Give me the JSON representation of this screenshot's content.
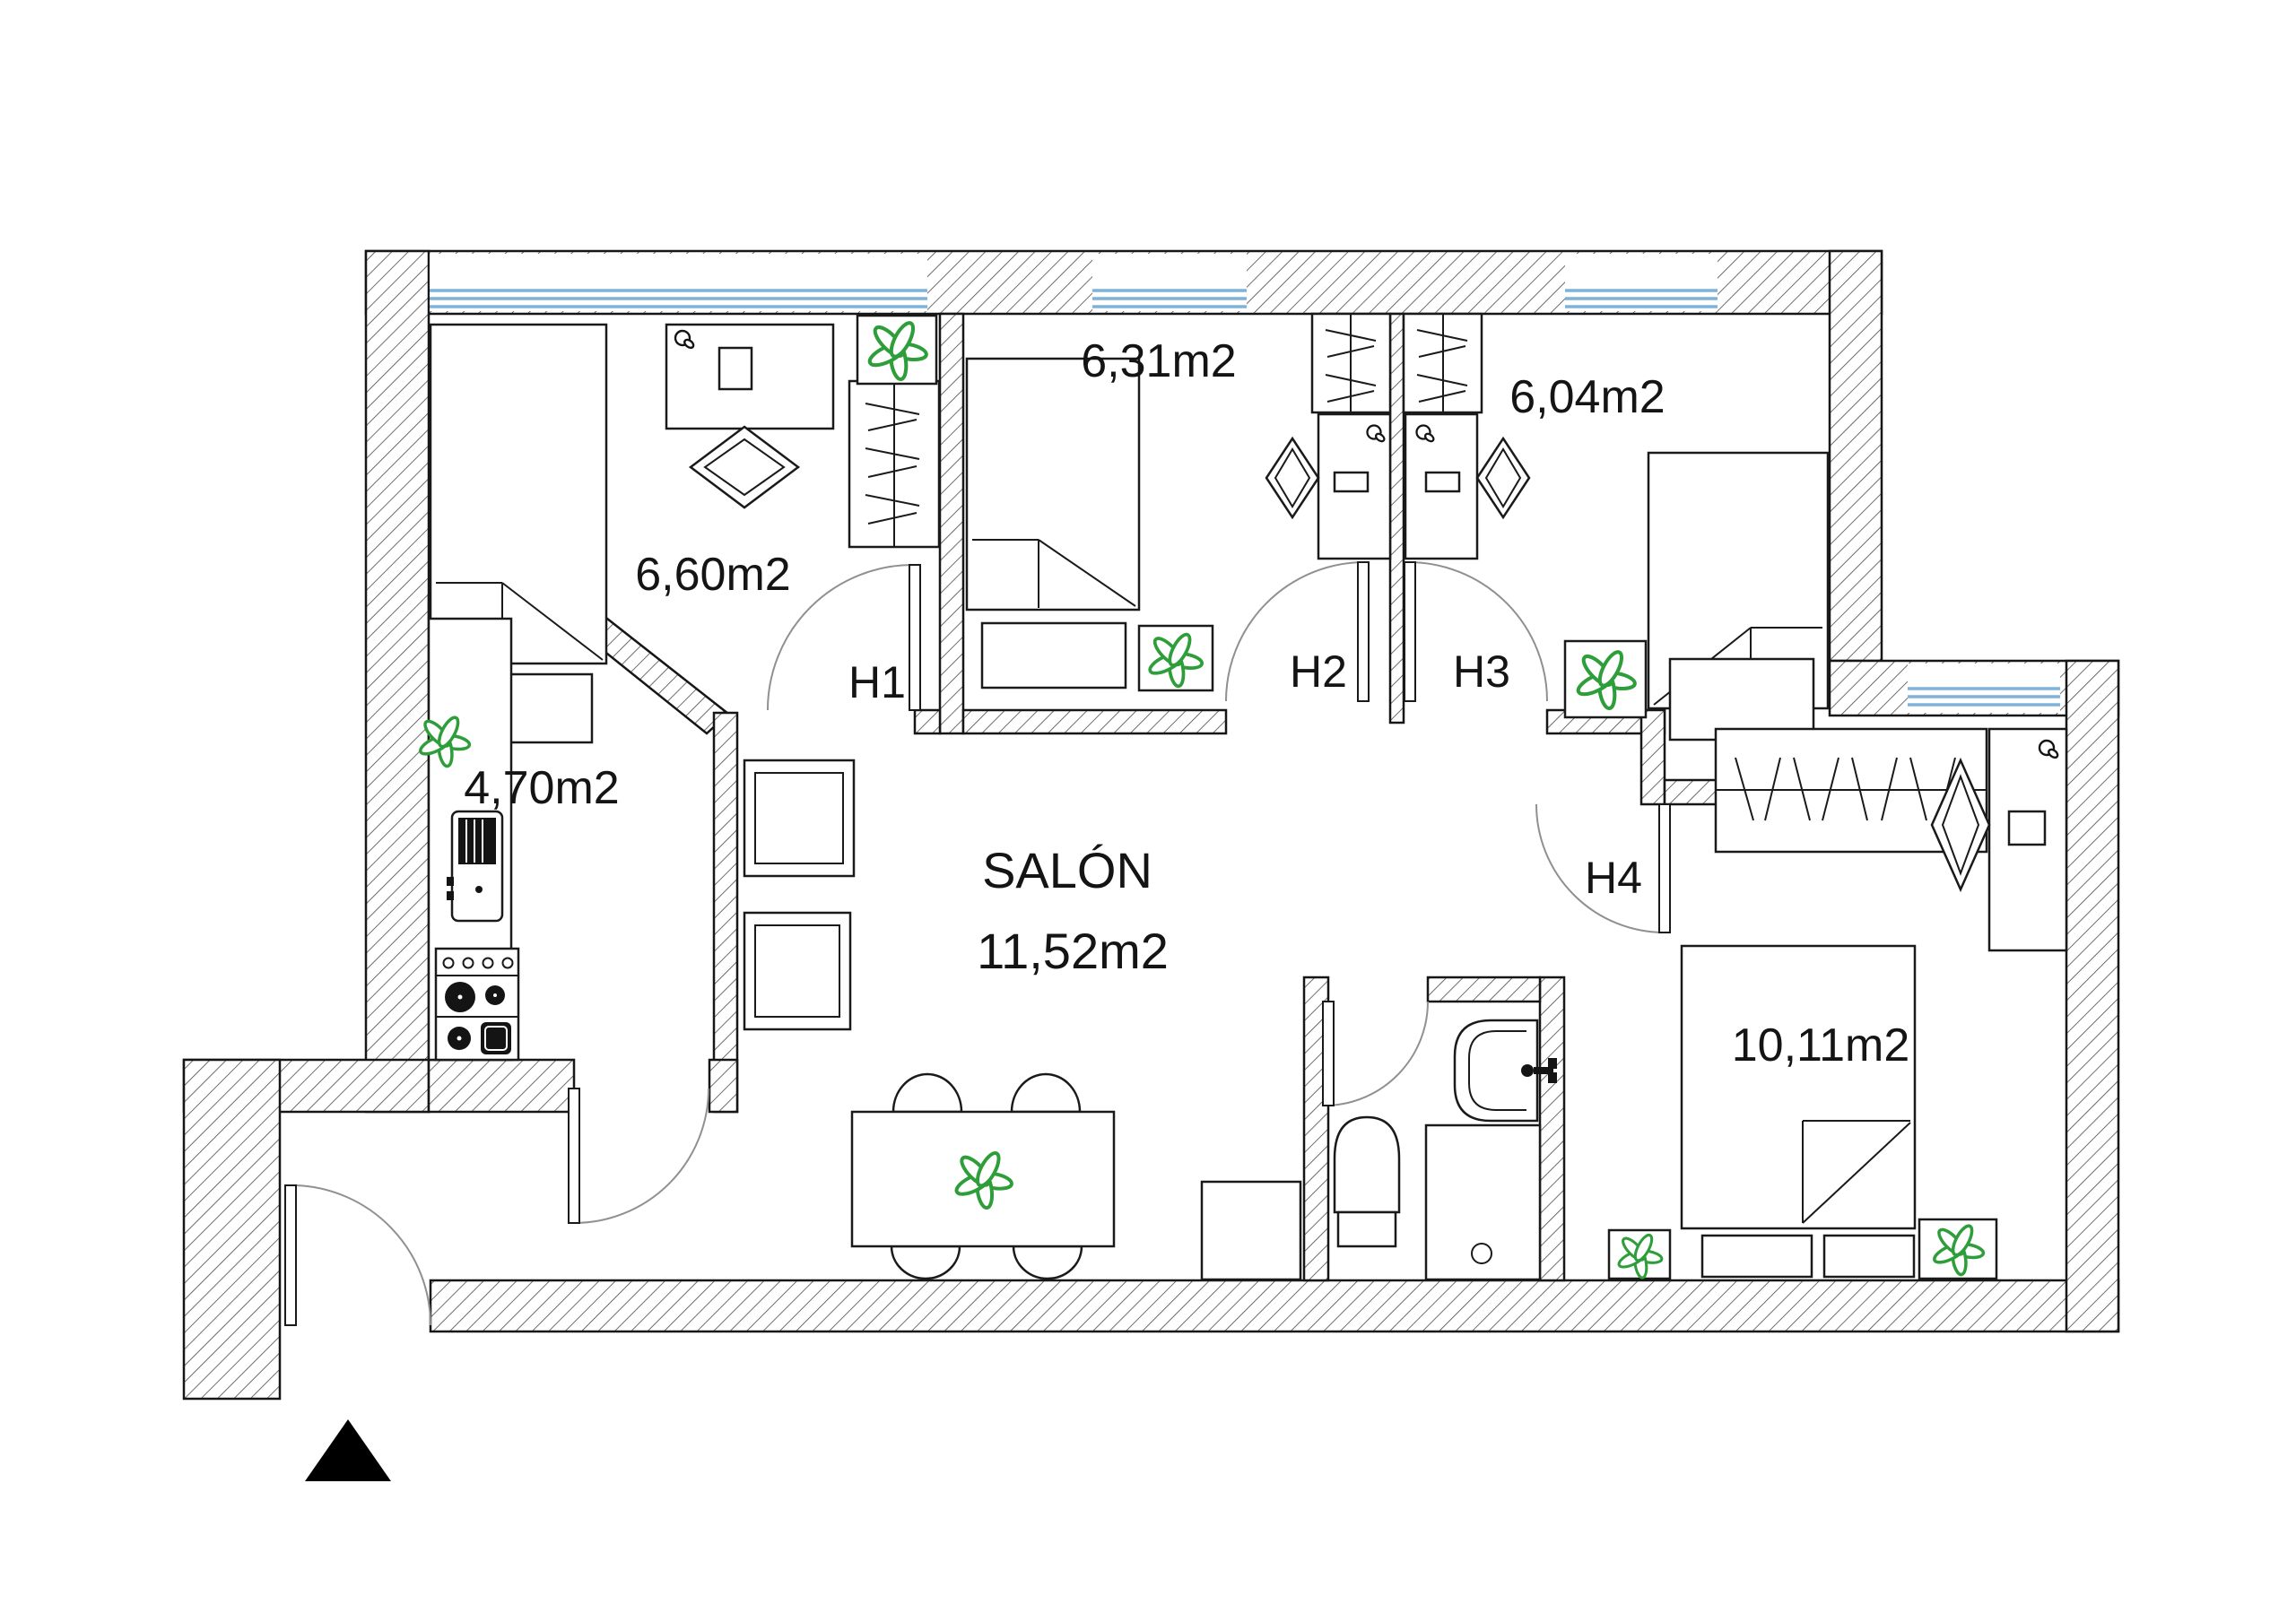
{
  "labels": {
    "room1_area": "6,60m2",
    "room2_area": "6,31m2",
    "room3_area": "6,04m2",
    "kitchen_area": "4,70m2",
    "salon_name": "SALÓN",
    "salon_area": "11,52m2",
    "room4_area": "10,11m2",
    "door1": "H1",
    "door2": "H2",
    "door3": "H3",
    "door4": "H4"
  },
  "rooms": [
    {
      "id": "bedroom-h1",
      "door": "H1",
      "area": "6,60m2",
      "furniture": [
        "bed",
        "under-bed-drawer",
        "desk",
        "desk-chair",
        "wardrobe",
        "plant-box"
      ]
    },
    {
      "id": "bedroom-h2",
      "door": "H2",
      "area": "6,31m2",
      "furniture": [
        "bed",
        "under-bed-drawer",
        "plant-box",
        "wardrobe",
        "desk",
        "desk-chair"
      ]
    },
    {
      "id": "bedroom-h3",
      "door": "H3",
      "area": "6,04m2",
      "furniture": [
        "bed",
        "nightstand",
        "plant-box",
        "wardrobe",
        "desk",
        "desk-chair"
      ]
    },
    {
      "id": "kitchen",
      "area": "4,70m2",
      "furniture": [
        "counter",
        "fridge",
        "stove",
        "plant"
      ]
    },
    {
      "id": "living-room",
      "name": "SALÓN",
      "area": "11,52m2",
      "furniture": [
        "dining-table",
        "table-plant",
        "chairs",
        "armchairs",
        "cabinet"
      ]
    },
    {
      "id": "bathroom",
      "furniture": [
        "sink",
        "toilet",
        "shower"
      ]
    },
    {
      "id": "bedroom-h4",
      "door": "H4",
      "area": "10,11m2",
      "furniture": [
        "wardrobe",
        "desk",
        "desk-chair",
        "bed",
        "under-bed-drawers",
        "plant-boxes"
      ]
    }
  ],
  "colors": {
    "wall_line": "#161616",
    "wall_hatch": "#4a4a4a",
    "window_glass": "#7fb2d9",
    "plant_green": "#2e9e3a",
    "door_arc": "#909090",
    "entrance_marker": "#000000"
  },
  "icons": {
    "plant": "plant-icon",
    "key": "key-icon",
    "entrance": "entrance-triangle-icon"
  }
}
